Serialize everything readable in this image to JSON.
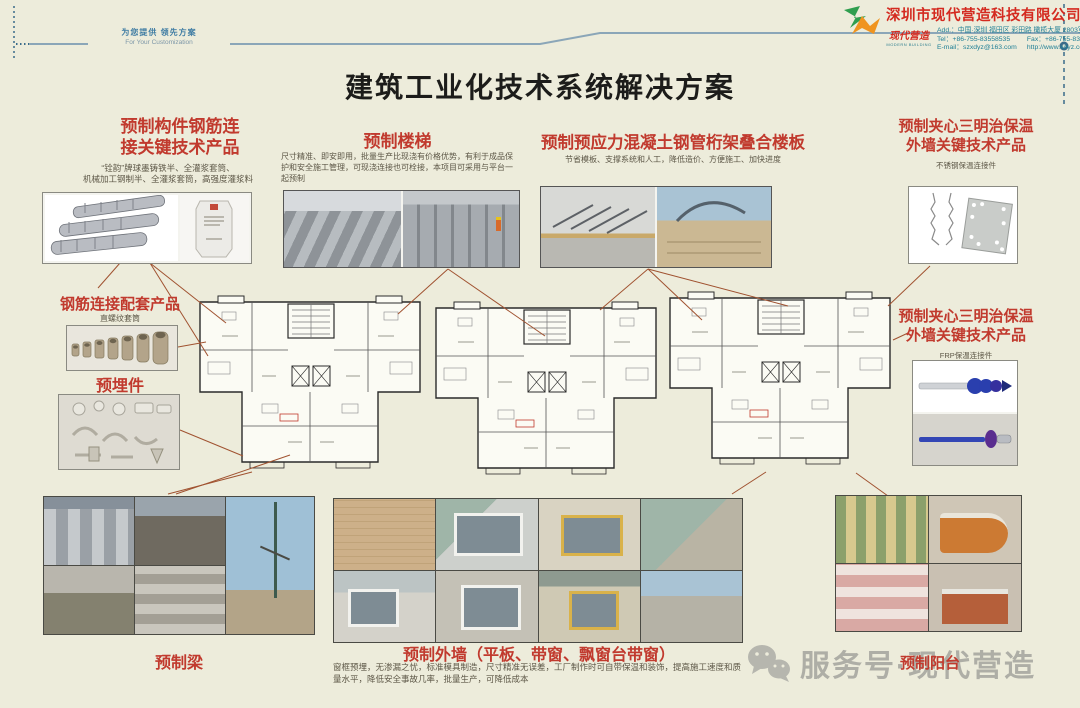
{
  "header": {
    "tagline_cn": "为您提供 领先方案",
    "tagline_en": "For Your Customization",
    "title": "建筑工业化技术系统解决方案"
  },
  "company": {
    "name": "深圳市现代营造科技有限公司",
    "logo_script": "现代营造",
    "logo_sub": "MODERN BUILDING",
    "address": "Add.：中国·深圳 福田区 彩田路 橄榄大厦 2803室",
    "tel": "Tel：+86-755-83558535",
    "fax": "Fax：+86-755-83467136",
    "email": "E-mail：szxdyz@163.com",
    "website": "http://www.xdyz.com.cn/"
  },
  "sections": {
    "rebar": {
      "title1": "预制构件钢筋连",
      "title2": "接关键技术产品",
      "desc1": "“铨韵”牌球墨铸铁半、全灌浆套筒、",
      "desc2": "机械加工钢制半、全灌浆套筒，高强度灌浆料"
    },
    "stairs": {
      "title": "预制楼梯",
      "desc": "尺寸精准、即安即用，批量生产比现浇有价格优势，有利于成品保护和安全施工管理，可现浇连接也可栓接，本项目可采用与平台一起预制"
    },
    "slab": {
      "title": "预制预应力混凝土钢管桁架叠合楼板",
      "desc": "节省模板、支撑系统和人工，降低造价、方便施工、加快进度"
    },
    "sandwich_top": {
      "title1": "预制夹心三明治保温",
      "title2": "外墙关键技术产品",
      "subtitle": "不锈钢保温连接件"
    },
    "coupler": {
      "title": "钢筋连接配套产品",
      "subtitle": "直螺纹套筒"
    },
    "embed": {
      "title": "预埋件"
    },
    "sandwich_right": {
      "title1": "预制夹心三明治保温",
      "title2": "外墙关键技术产品",
      "subtitle": "FRP保温连接件"
    },
    "beam": {
      "title": "预制梁"
    },
    "wall": {
      "title": "预制外墙（平板、带窗、飘窗台带窗）",
      "desc": "窗框预埋，无渗漏之忧，标准模具制造，尺寸精准无误差，工厂制作时可自带保温和装饰，提高施工速度和质量水平，降低安全事故几率，批量生产，可降低成本"
    },
    "balcony": {
      "title": "预制阳台"
    }
  },
  "watermark": {
    "icon": "wechat-icon",
    "text": "服务号·现代营造"
  },
  "colors": {
    "background": "#edecdb",
    "heading_red": "#c13a2e",
    "company_red": "#d42a20",
    "contact_teal": "#1f7f96",
    "header_line_blue": "#8ba6b8",
    "connector_brown": "#a05230"
  }
}
